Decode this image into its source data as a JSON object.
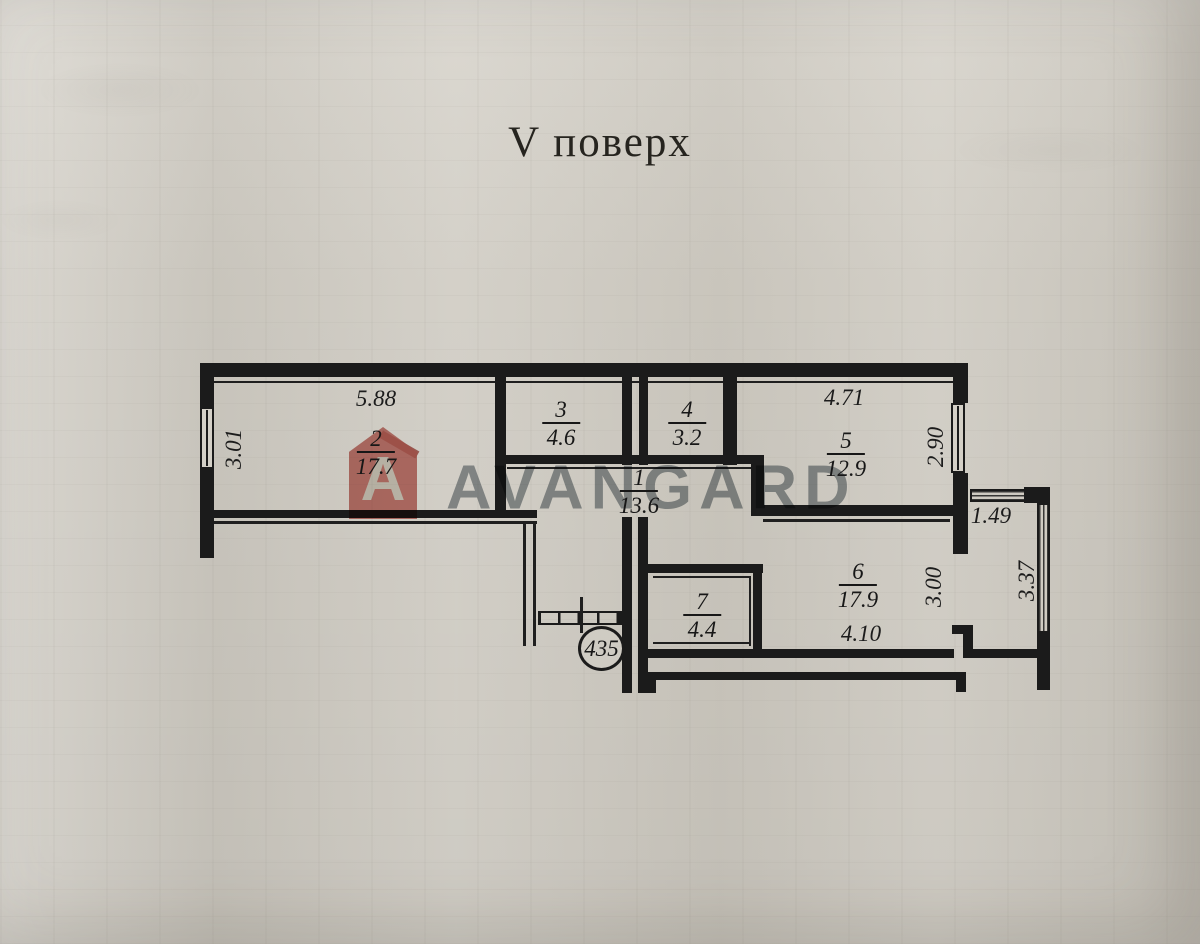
{
  "title": "V поверх",
  "apartment": {
    "number_label": "435"
  },
  "rooms": [
    {
      "number": "1",
      "area": "13.6"
    },
    {
      "number": "2",
      "area": "17.7"
    },
    {
      "number": "3",
      "area": "4.6"
    },
    {
      "number": "4",
      "area": "3.2"
    },
    {
      "number": "5",
      "area": "12.9"
    },
    {
      "number": "6",
      "area": "17.9"
    },
    {
      "number": "7",
      "area": "4.4"
    }
  ],
  "dimensions": {
    "room2_width": "5.88",
    "room2_depth": "3.01",
    "room5_width": "4.71",
    "room5_depth": "2.90",
    "room6_width": "4.10",
    "room6_depth": "3.00",
    "balcony_width": "1.49",
    "balcony_depth": "3.37"
  },
  "watermark": {
    "logo_letter": "A",
    "brand": "AVANGARD"
  },
  "colors": {
    "paper": "#d3cfc6",
    "ink": "#1b1b1b",
    "watermark_text": "#8e969b",
    "watermark_logo": "#c4655d"
  }
}
